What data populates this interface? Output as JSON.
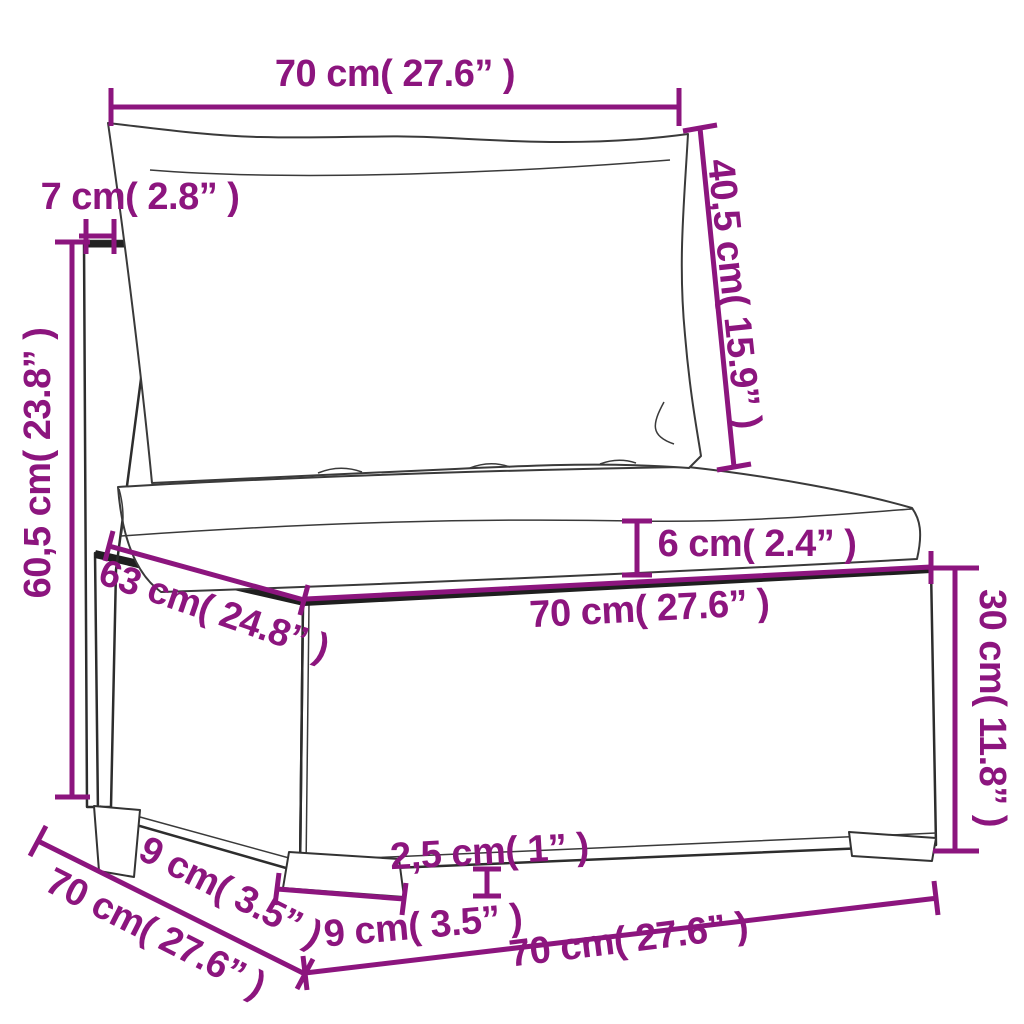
{
  "title": "Garden sofa middle section with cushions – dimension diagram",
  "style": {
    "dimension_color": "#8c157e",
    "sketch_line_color": "#2d2d2d",
    "background": "#ffffff"
  },
  "dimensions": [
    {
      "id": "top_width",
      "label": "70 cm( 27.6” )",
      "cm": "70",
      "inches": "27.6"
    },
    {
      "id": "back_thickness",
      "label": "7 cm( 2.8” )",
      "cm": "7",
      "inches": "2.8"
    },
    {
      "id": "back_height",
      "label": "40,5 cm( 15.9” )",
      "cm": "40,5",
      "inches": "15.9"
    },
    {
      "id": "total_height",
      "label": "60,5 cm( 23.8” )",
      "cm": "60,5",
      "inches": "23.8"
    },
    {
      "id": "cushion_thickness",
      "label": "6 cm( 2.4” )",
      "cm": "6",
      "inches": "2.4"
    },
    {
      "id": "seat_width",
      "label": "70 cm( 27.6” )",
      "cm": "70",
      "inches": "27.6"
    },
    {
      "id": "seat_depth",
      "label": "63 cm( 24.8” )",
      "cm": "63",
      "inches": "24.8"
    },
    {
      "id": "base_height",
      "label": "30 cm( 11.8” )",
      "cm": "30",
      "inches": "11.8"
    },
    {
      "id": "foot_height",
      "label": "2,5 cm( 1” )",
      "cm": "2,5",
      "inches": "1"
    },
    {
      "id": "foot_width",
      "label": "9 cm( 3.5” )",
      "cm": "9",
      "inches": "3.5"
    },
    {
      "id": "foot_depth",
      "label": "9 cm( 3.5” )",
      "cm": "9",
      "inches": "3.5"
    },
    {
      "id": "side_depth",
      "label": "70 cm( 27.6” )",
      "cm": "70",
      "inches": "27.6"
    },
    {
      "id": "bottom_width",
      "label": "70 cm( 27.6” )",
      "cm": "70",
      "inches": "27.6"
    }
  ]
}
